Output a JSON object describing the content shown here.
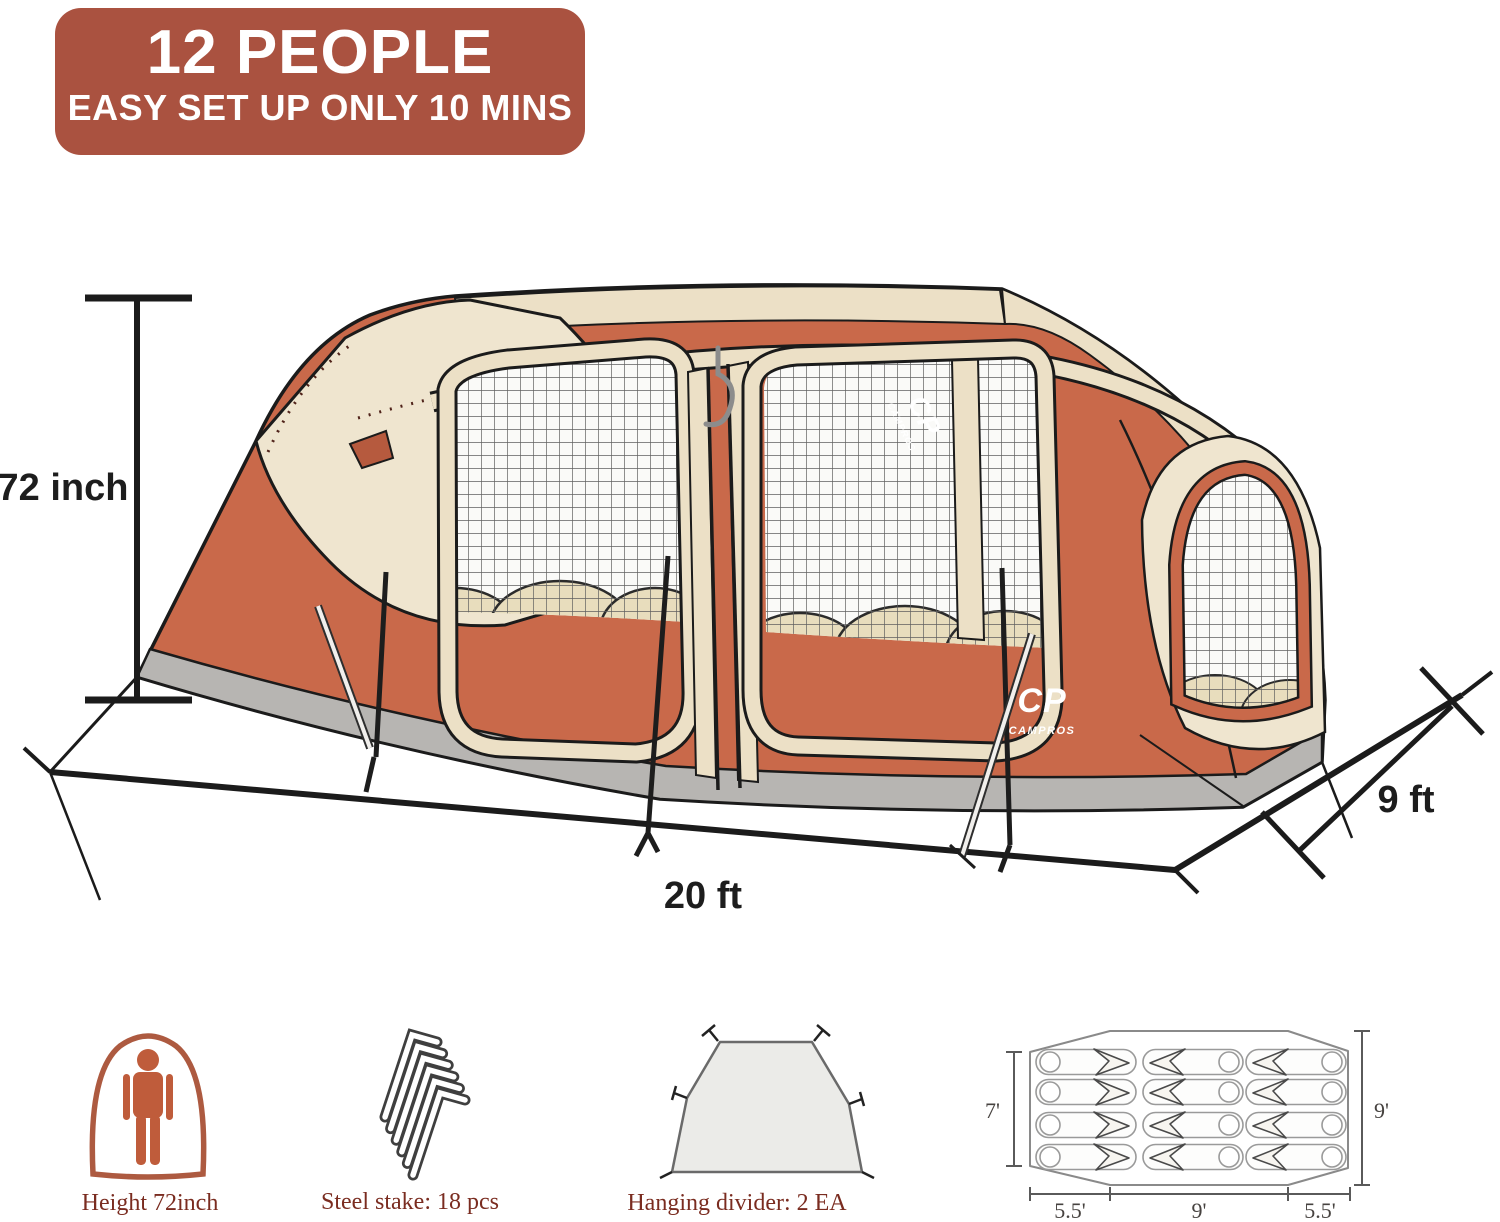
{
  "badge": {
    "title": "12 PEOPLE",
    "subtitle": "EASY SET UP ONLY 10 MINS"
  },
  "dims": {
    "height": "72 inch",
    "length": "20 ft",
    "depth": "9 ft"
  },
  "brand": {
    "initials": "CP",
    "name": "CAMPROS"
  },
  "features": {
    "height": {
      "caption": "Height 72inch"
    },
    "stakes": {
      "caption": "Steel stake: 18 pcs"
    },
    "divider": {
      "caption": "Hanging divider: 2 EA"
    }
  },
  "floorplan": {
    "left": "7'",
    "right": "9'",
    "bottom_left": "5.5'",
    "bottom_center": "9'",
    "bottom_right": "5.5'"
  },
  "colors": {
    "badge": "#aa5240",
    "tent_orange": "#c9694a",
    "canvas_cream": "#ece0c6",
    "skirt_gray": "#b7b5b2",
    "caption_red": "#7a2c20"
  }
}
